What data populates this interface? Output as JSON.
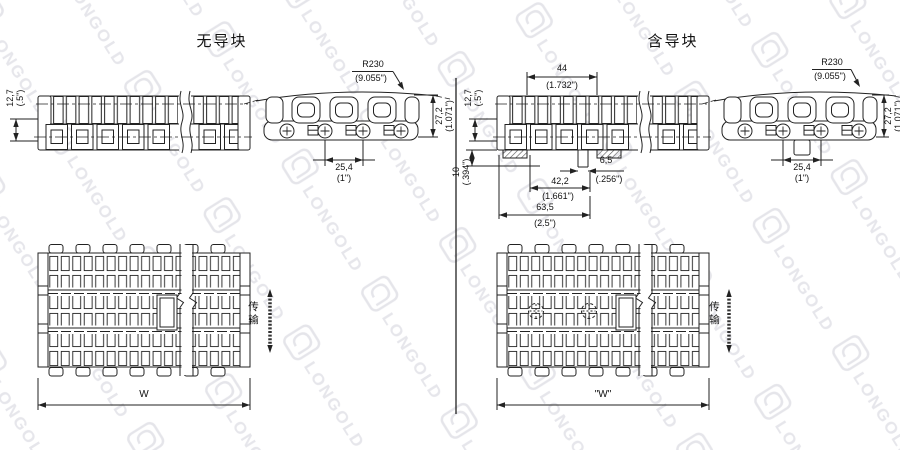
{
  "watermark": {
    "brand": "LONGOLD"
  },
  "left": {
    "title": "无导块",
    "side": {
      "thickness_mm": "12,7",
      "thickness_in": "(.5\")"
    },
    "front": {
      "radius_mm": "R230",
      "radius_in": "(9.055\")",
      "height_mm": "27,2",
      "height_in": "(1.071\")",
      "pitch_mm": "25,4",
      "pitch_in": "(1\")"
    },
    "top": {
      "width": "W",
      "flow": "传输"
    }
  },
  "right": {
    "title": "含导块",
    "side": {
      "thickness_mm": "12,7",
      "thickness_in": "(.5\")",
      "block_width_mm": "44",
      "block_width_in": "(1.732\")",
      "block_height_mm": "10",
      "block_height_in": "(.394\")",
      "tab_mm": "6,5",
      "tab_in": "(.256\")",
      "span_mm": "42,2",
      "span_in": "(1.661\")",
      "overall_mm": "63,5",
      "overall_in": "(2.5\")"
    },
    "front": {
      "radius_mm": "R230",
      "radius_in": "(9.055\")",
      "height_mm": "27,2",
      "height_in": "(1.071\")",
      "pitch_mm": "25,4",
      "pitch_in": "(1\")"
    },
    "top": {
      "width": "\"W\"",
      "flow": "传输"
    }
  }
}
